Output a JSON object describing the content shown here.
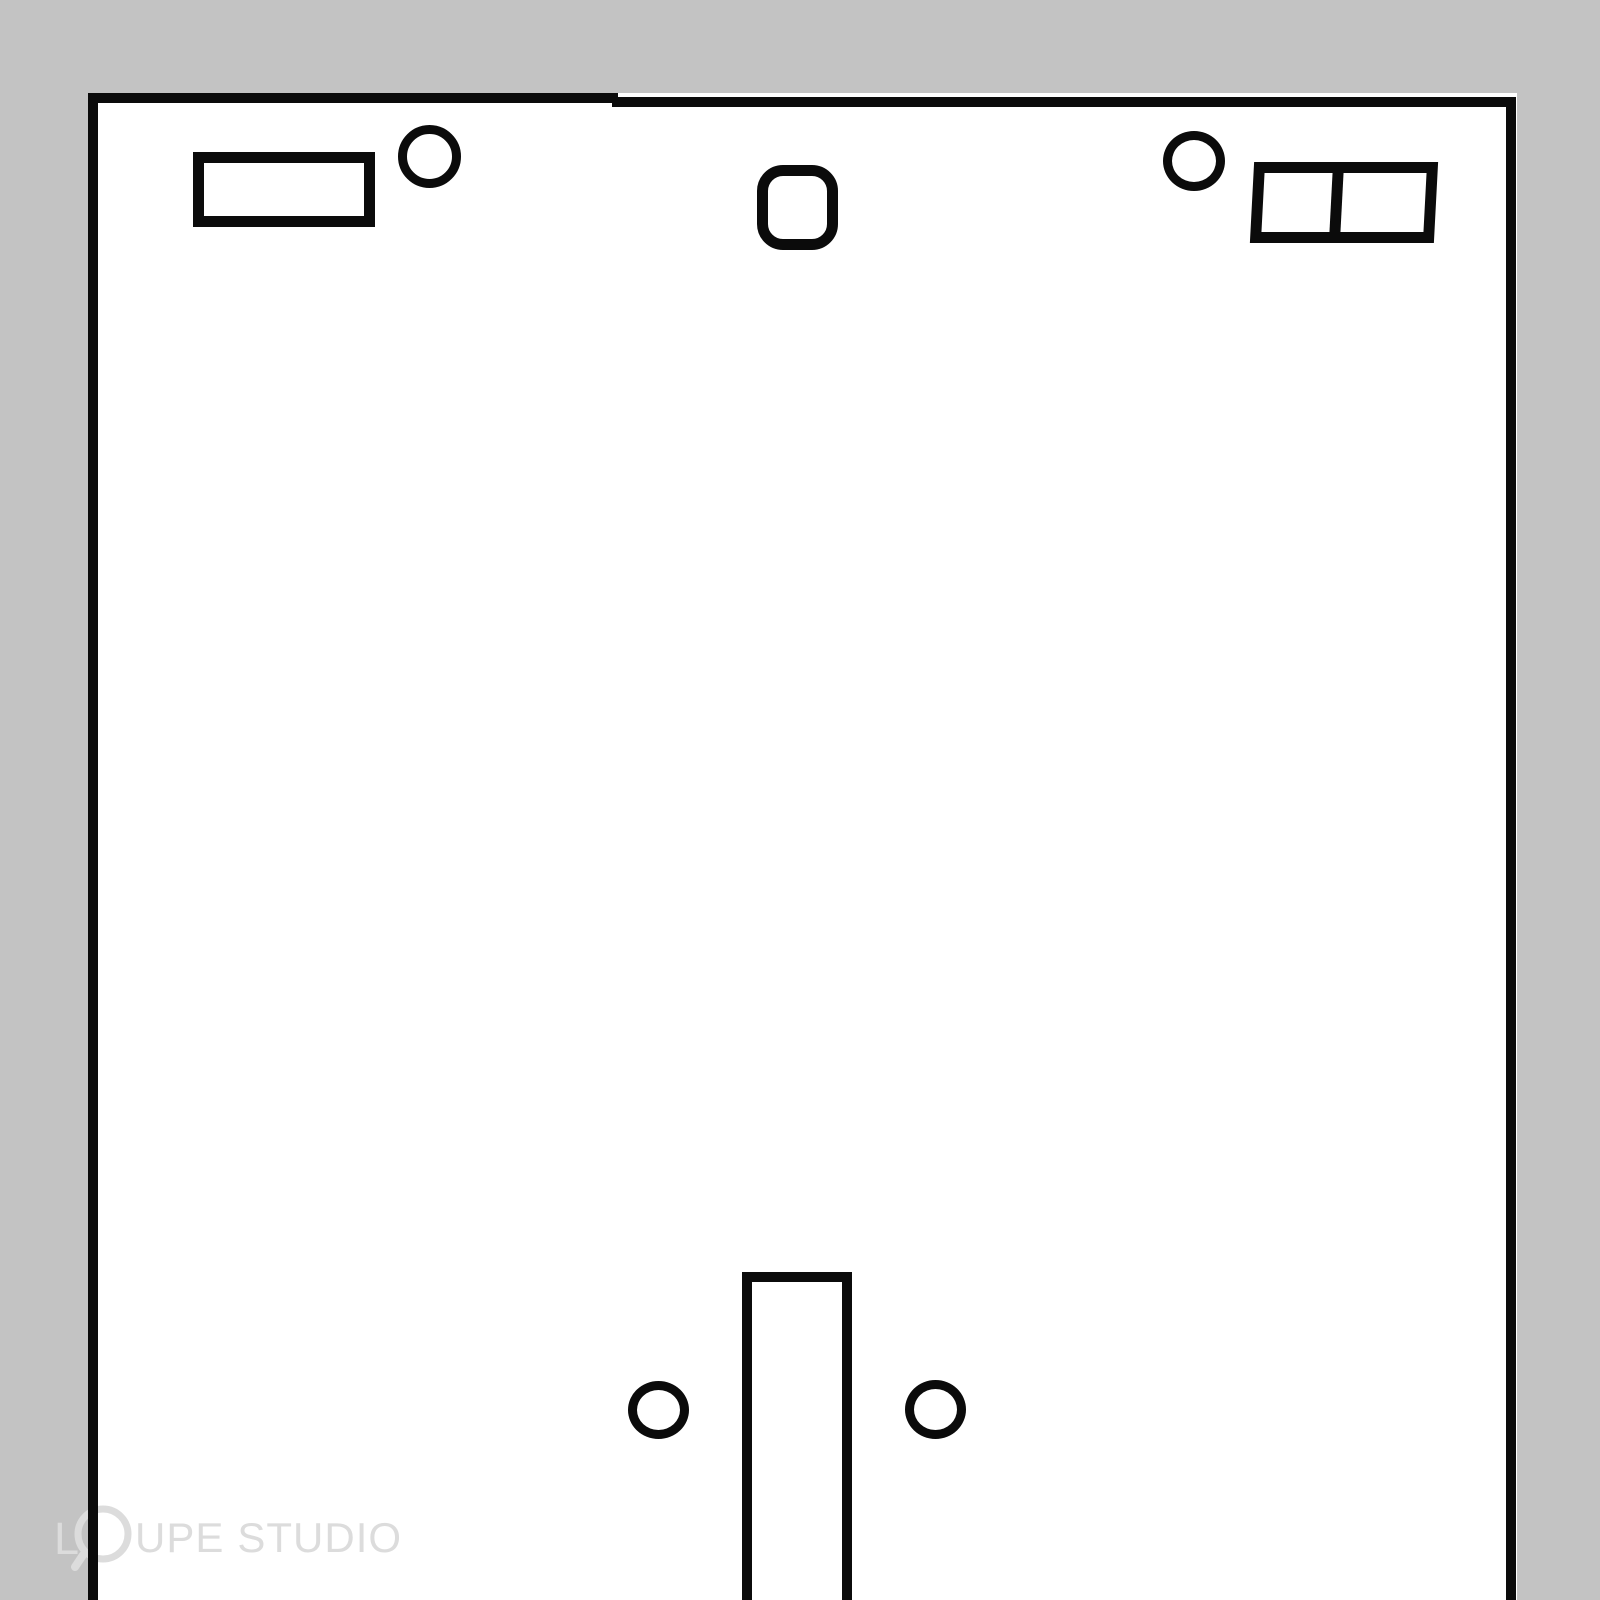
{
  "colors": {
    "background": "#c3c3c3",
    "surface": "#ffffff",
    "ink": "#0b0b0b",
    "watermark": "#dcdcdc"
  },
  "watermark": {
    "full_text": "LOUPE STUDIO",
    "text_l": "L",
    "text_upe": "UPE",
    "text_studio": "STUDIO",
    "loupe_icon": "loupe-magnifier-icon",
    "style_box": {
      "left": "54px",
      "top": "1504px",
      "height": "68px"
    }
  },
  "diagram": {
    "description": "Hand-drawn black outline diagram of a tall rectangular panel on a gray background: small rectangle and round hole at top-left, rounded-square opening at top-center, round hole and two-compartment rectangle at top-right, and a vertical slot flanked by two round holes at the bottom-center; panel runs off the bottom edge.",
    "geometry": {
      "panel_surface": {
        "left": "88px",
        "top": "93px",
        "width": "1429px",
        "height": "1507px"
      },
      "border_left": {
        "left": "88px",
        "top": "93px",
        "width": "10px",
        "height": "1507px"
      },
      "border_top_a": {
        "left": "88px",
        "top": "93px",
        "width": "530px",
        "height": "10px"
      },
      "border_top_b": {
        "left": "612px",
        "top": "97px",
        "width": "904px",
        "height": "10px"
      },
      "border_right": {
        "left": "1506px",
        "top": "97px",
        "width": "10px",
        "height": "1503px"
      },
      "rect_top_left": {
        "left": "193px",
        "top": "152px",
        "width": "182px",
        "height": "75px",
        "borderWidth": "11px"
      },
      "circle_top_left": {
        "left": "398px",
        "top": "125px",
        "width": "63px",
        "height": "63px",
        "borderWidth": "9px"
      },
      "rounded_square": {
        "left": "757px",
        "top": "165px",
        "width": "81px",
        "height": "85px",
        "borderWidth": "11px",
        "borderRadius": "26px"
      },
      "circle_top_right": {
        "left": "1163px",
        "top": "131px",
        "width": "62px",
        "height": "60px",
        "borderWidth": "9px"
      },
      "dual_rect": {
        "left": "1252px",
        "top": "162px",
        "width": "184px",
        "height": "81px",
        "borderWidth": "11px",
        "transform": "skewX(-3deg)"
      },
      "dual_rect_divider": {
        "left": "68px",
        "top": "0px",
        "width": "11px",
        "height": "59px"
      },
      "slot": {
        "left": "742px",
        "top": "1272px",
        "width": "110px",
        "height": "332px",
        "borderWidth": "10px",
        "borderBottom": "none"
      },
      "circle_bottom_left": {
        "left": "628px",
        "top": "1381px",
        "width": "61px",
        "height": "58px",
        "borderWidth": "9px"
      },
      "circle_bottom_right": {
        "left": "905px",
        "top": "1380px",
        "width": "61px",
        "height": "59px",
        "borderWidth": "9px"
      }
    }
  }
}
